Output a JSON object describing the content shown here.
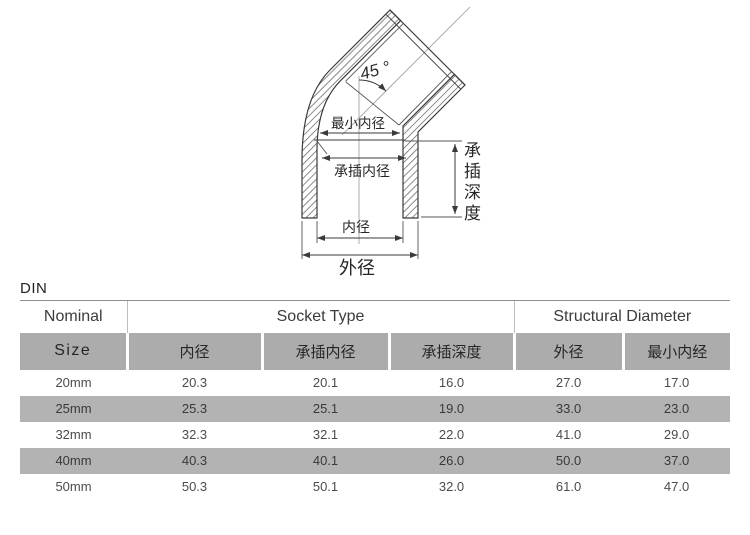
{
  "diagram": {
    "angle_label": "45 °",
    "labels": {
      "min_inner_diameter": "最小内径",
      "socket_inner_diameter": "承插内径",
      "inner_diameter": "内径",
      "outer_diameter": "外径",
      "socket_depth": "承插深度"
    }
  },
  "table": {
    "standard": "DIN",
    "group_headers": {
      "nominal": "Nominal",
      "socket_type": "Socket Type",
      "structural_diameter": "Structural Diameter"
    },
    "columns": {
      "size": "Size",
      "inner_diameter": "内径",
      "socket_inner_diameter": "承插内径",
      "socket_depth": "承插深度",
      "outer_diameter": "外径",
      "min_inner_diameter": "最小内经"
    },
    "rows": [
      {
        "size": "20mm",
        "inner_diameter": "20.3",
        "socket_inner_diameter": "20.1",
        "socket_depth": "16.0",
        "outer_diameter": "27.0",
        "min_inner_diameter": "17.0"
      },
      {
        "size": "25mm",
        "inner_diameter": "25.3",
        "socket_inner_diameter": "25.1",
        "socket_depth": "19.0",
        "outer_diameter": "33.0",
        "min_inner_diameter": "23.0"
      },
      {
        "size": "32mm",
        "inner_diameter": "32.3",
        "socket_inner_diameter": "32.1",
        "socket_depth": "22.0",
        "outer_diameter": "41.0",
        "min_inner_diameter": "29.0"
      },
      {
        "size": "40mm",
        "inner_diameter": "40.3",
        "socket_inner_diameter": "40.1",
        "socket_depth": "26.0",
        "outer_diameter": "50.0",
        "min_inner_diameter": "37.0"
      },
      {
        "size": "50mm",
        "inner_diameter": "50.3",
        "socket_inner_diameter": "50.1",
        "socket_depth": "32.0",
        "outer_diameter": "61.0",
        "min_inner_diameter": "47.0"
      }
    ]
  },
  "colors": {
    "header-gray": "#acacac",
    "stripe-gray": "#b3b3b3",
    "line-dark": "#3a3a3a"
  }
}
